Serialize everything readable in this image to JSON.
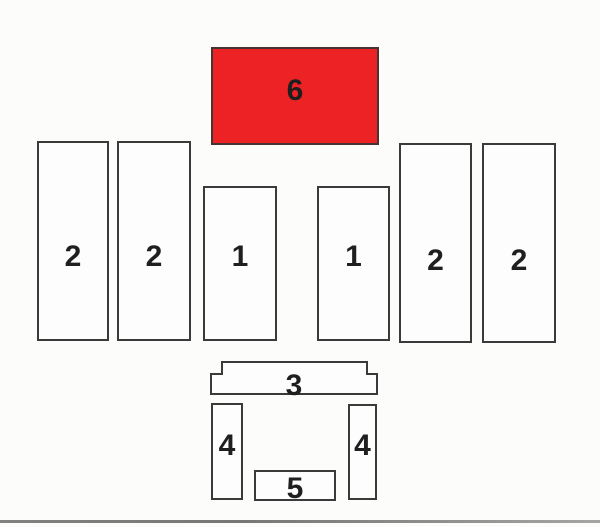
{
  "diagram": {
    "description_labels": {
      "part6": "6",
      "part2_left_outer": "2",
      "part2_left_inner": "2",
      "part1_left": "1",
      "part1_right": "1",
      "part2_right_inner": "2",
      "part2_right_outer": "2",
      "part3": "3",
      "part4_left": "4",
      "part4_right": "4",
      "part5": "5"
    },
    "colors": {
      "highlight": "#ed2224",
      "highlight_border": "#453431",
      "outline": "#3a3a3a",
      "ink": "#1f1f1f",
      "box_fill": "#fdfdfd",
      "background": "#fcfcfb"
    }
  }
}
